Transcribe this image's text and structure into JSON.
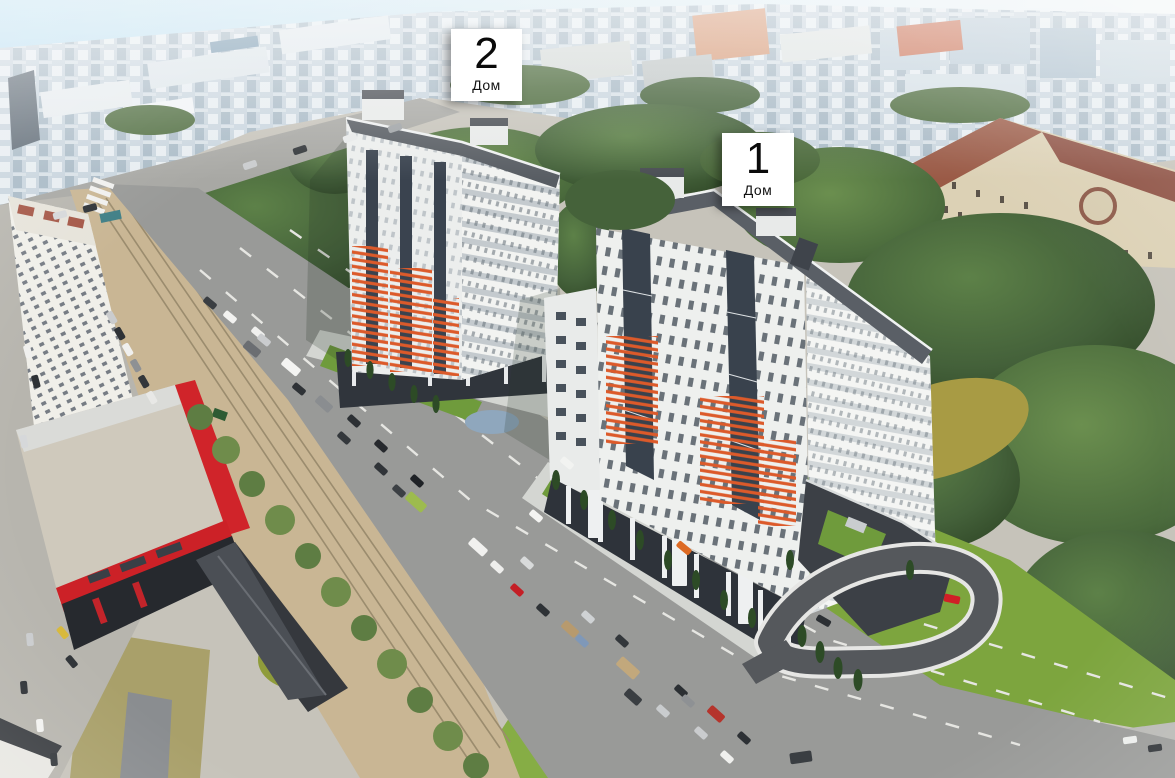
{
  "scene": {
    "type": "aerial-architectural-rendering",
    "labels": [
      {
        "number": "2",
        "caption": "Дом"
      },
      {
        "number": "1",
        "caption": "Дом"
      }
    ],
    "palette": {
      "sky_blue": "#bfe1f1",
      "facade_white": "#eff0ee",
      "accent_orange": "#dc5a2a",
      "glazing_dark": "#3a434f",
      "roof_dark": "#585d63",
      "tree_green": "#3f5c33",
      "lawn_green": "#7da53e",
      "road_gray": "#999a98",
      "median_sand": "#c9b694",
      "mall_red": "#cc2127",
      "classical_beige": "#dcd1b5",
      "classical_roof": "#9a5a46"
    }
  }
}
